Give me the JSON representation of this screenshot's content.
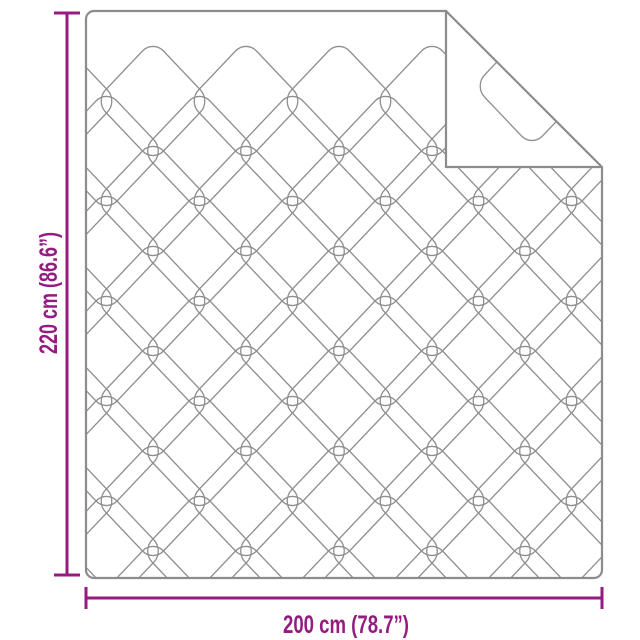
{
  "diagram": {
    "type": "product-dimension-diagram",
    "product": "quilted-blanket-with-folded-corner",
    "height_label": "220 cm (86.6”)",
    "width_label": "200 cm (78.7”)",
    "accent_color": "#951b81",
    "outline_color": "#8c8c8c",
    "pattern_color": "#8f8f8f",
    "background_color": "#ffffff"
  }
}
